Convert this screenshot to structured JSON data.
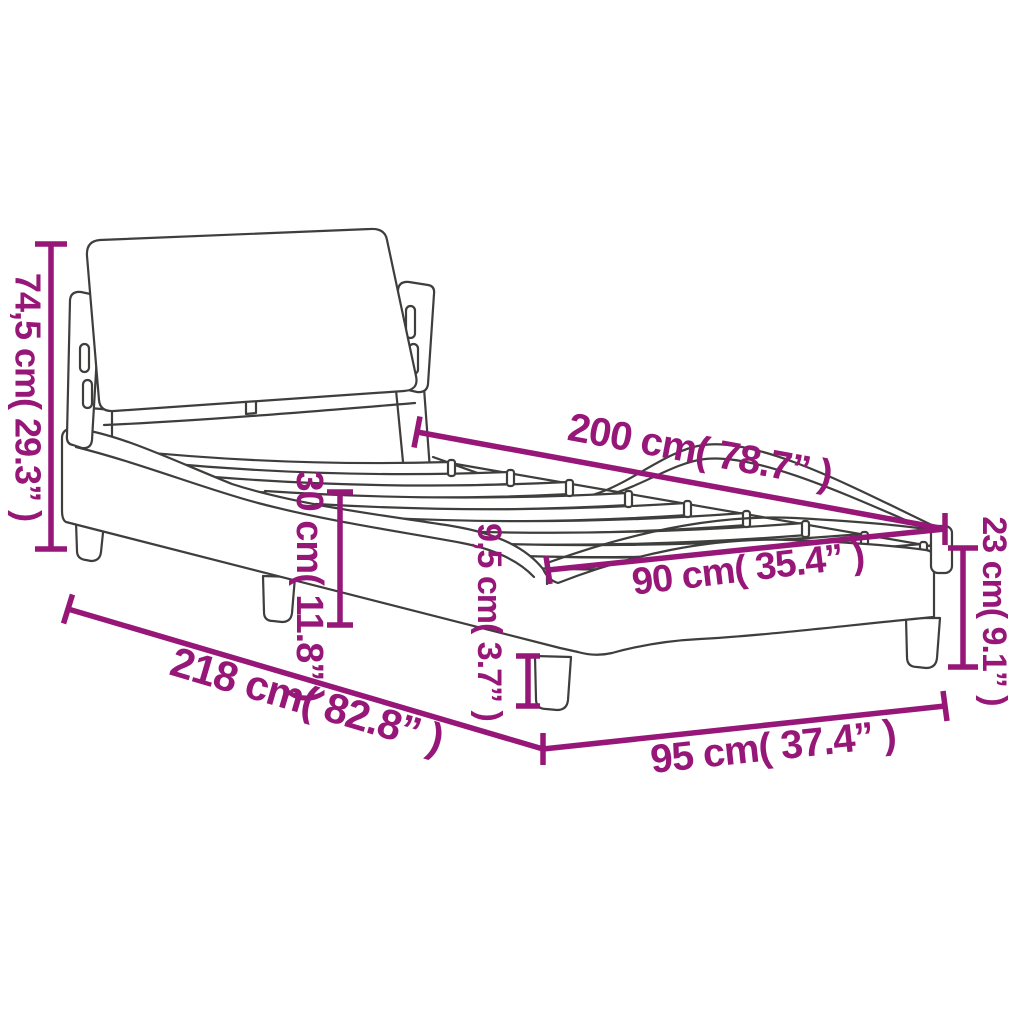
{
  "colors": {
    "dimension": "#971778",
    "line_art": "#3E3E3D",
    "background": "#FFFFFF"
  },
  "dims": {
    "total_height": {
      "label": "74,5 cm( 29.3” )"
    },
    "length": {
      "label": "200 cm( 78.7” )"
    },
    "side_height": {
      "label": "30 cm( 11.8” )"
    },
    "leg_height": {
      "label": "9,5 cm( 3.7” )"
    },
    "foot_height": {
      "label": "23 cm( 9.1” )"
    },
    "width": {
      "label": "90 cm( 35.4” )"
    },
    "total_length": {
      "label": "218 cm( 82.8” )"
    },
    "total_width": {
      "label": "95 cm( 37.4” )"
    }
  }
}
